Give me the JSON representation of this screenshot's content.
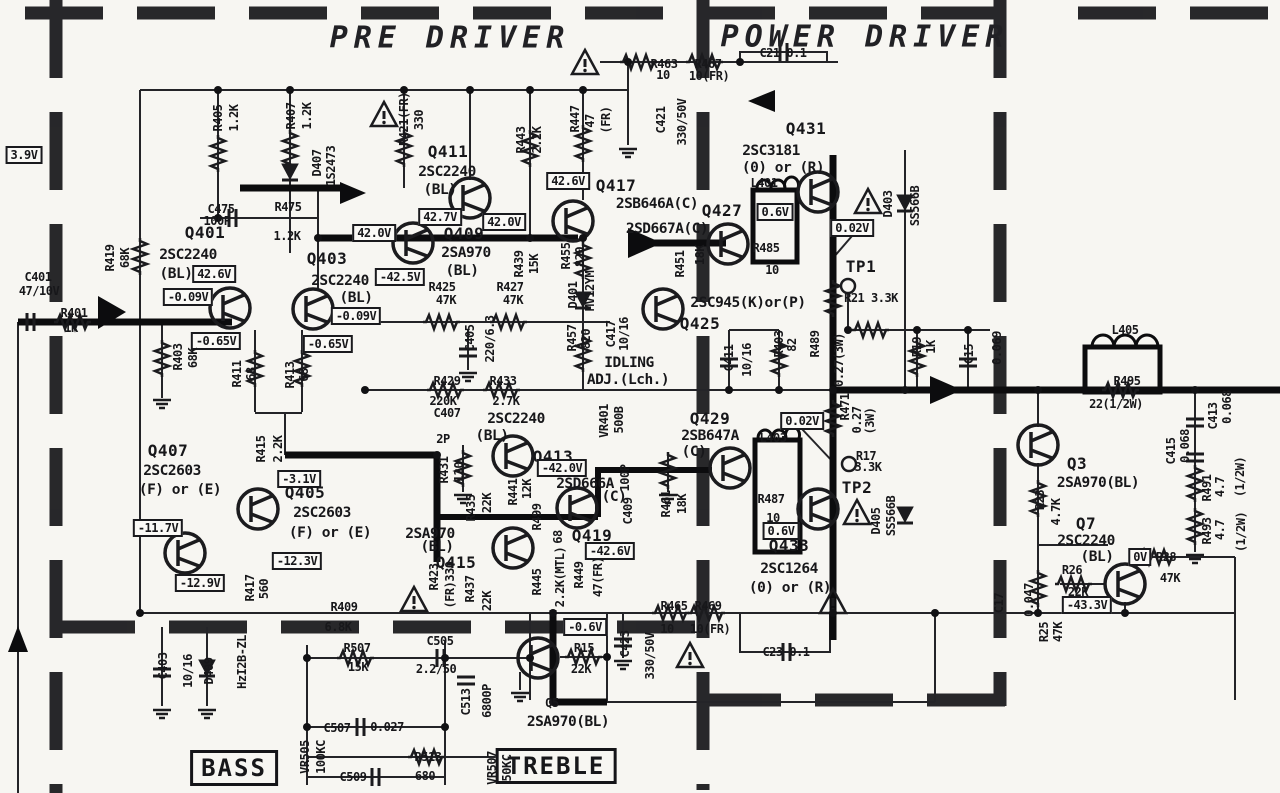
{
  "titles": {
    "pre": "PRE DRIVER",
    "power": "POWER DRIVER"
  },
  "tone": {
    "bass": "BASS",
    "treble": "TREBLE"
  },
  "colors": {
    "ink": "#1b1b1e",
    "paper": "#f7f6f2"
  },
  "labels": [
    {
      "t": "3.9V",
      "x": 24,
      "y": 155,
      "c": "b"
    },
    {
      "t": "R405",
      "x": 218,
      "y": 118,
      "c": "v"
    },
    {
      "t": "1.2K",
      "x": 234,
      "y": 118,
      "c": "v"
    },
    {
      "t": "R407",
      "x": 291,
      "y": 116,
      "c": "v"
    },
    {
      "t": "1.2K",
      "x": 307,
      "y": 116,
      "c": "v"
    },
    {
      "t": "D407",
      "x": 317,
      "y": 163,
      "c": "v"
    },
    {
      "t": "1S2473",
      "x": 331,
      "y": 166,
      "c": "v"
    },
    {
      "t": "R421(FR)",
      "x": 404,
      "y": 119,
      "c": "v"
    },
    {
      "t": "330",
      "x": 419,
      "y": 120,
      "c": "v"
    },
    {
      "t": "R443",
      "x": 521,
      "y": 140,
      "c": "v"
    },
    {
      "t": "2.2K",
      "x": 537,
      "y": 140,
      "c": "v"
    },
    {
      "t": "R447",
      "x": 575,
      "y": 119,
      "c": "v"
    },
    {
      "t": "47",
      "x": 590,
      "y": 121,
      "c": "v"
    },
    {
      "t": "(FR)",
      "x": 606,
      "y": 120,
      "c": "v"
    },
    {
      "t": "C421",
      "x": 661,
      "y": 120,
      "c": "v"
    },
    {
      "t": "330/50V",
      "x": 682,
      "y": 122,
      "c": "v"
    },
    {
      "t": "R463",
      "x": 664,
      "y": 64
    },
    {
      "t": "10",
      "x": 663,
      "y": 75
    },
    {
      "t": "R467",
      "x": 708,
      "y": 64
    },
    {
      "t": "10(FR)",
      "x": 709,
      "y": 76
    },
    {
      "t": "C21 0.1",
      "x": 783,
      "y": 53
    },
    {
      "t": "Q411",
      "x": 448,
      "y": 152,
      "c": "q"
    },
    {
      "t": "2SC2240",
      "x": 447,
      "y": 172,
      "c": "p"
    },
    {
      "t": "(BL)",
      "x": 440,
      "y": 190,
      "c": "p"
    },
    {
      "t": "Q431",
      "x": 806,
      "y": 129,
      "c": "q"
    },
    {
      "t": "2SC3181",
      "x": 771,
      "y": 151,
      "c": "p"
    },
    {
      "t": "(0) or (R)",
      "x": 783,
      "y": 168,
      "c": "p"
    },
    {
      "t": "L401",
      "x": 764,
      "y": 183
    },
    {
      "t": "D403",
      "x": 888,
      "y": 204,
      "c": "v"
    },
    {
      "t": "SS566B",
      "x": 915,
      "y": 206,
      "c": "v"
    },
    {
      "t": "42.6V",
      "x": 568,
      "y": 181,
      "c": "b"
    },
    {
      "t": "Q417",
      "x": 616,
      "y": 186,
      "c": "q"
    },
    {
      "t": "2SB646A(C)",
      "x": 657,
      "y": 204,
      "c": "p"
    },
    {
      "t": "2SD667A(C)",
      "x": 667,
      "y": 229,
      "c": "p"
    },
    {
      "t": "Q427",
      "x": 722,
      "y": 211,
      "c": "q"
    },
    {
      "t": "0.6V",
      "x": 775,
      "y": 212,
      "c": "b"
    },
    {
      "t": "0.02V",
      "x": 852,
      "y": 228,
      "c": "b"
    },
    {
      "t": "C475",
      "x": 221,
      "y": 209
    },
    {
      "t": "100P",
      "x": 217,
      "y": 221
    },
    {
      "t": "R475",
      "x": 288,
      "y": 207
    },
    {
      "t": "1.2K",
      "x": 287,
      "y": 236
    },
    {
      "t": "42.7V",
      "x": 440,
      "y": 217,
      "c": "b"
    },
    {
      "t": "42.0V",
      "x": 504,
      "y": 222,
      "c": "b"
    },
    {
      "t": "42.0V",
      "x": 374,
      "y": 233,
      "c": "b"
    },
    {
      "t": "Q401",
      "x": 205,
      "y": 233,
      "c": "q"
    },
    {
      "t": "2SC2240",
      "x": 188,
      "y": 255,
      "c": "p"
    },
    {
      "t": "(BL)",
      "x": 176,
      "y": 274,
      "c": "p"
    },
    {
      "t": "42.6V",
      "x": 214,
      "y": 274,
      "c": "b"
    },
    {
      "t": "Q409",
      "x": 464,
      "y": 234,
      "c": "q"
    },
    {
      "t": "2SA970",
      "x": 466,
      "y": 253,
      "c": "p"
    },
    {
      "t": "(BL)",
      "x": 462,
      "y": 271,
      "c": "p"
    },
    {
      "t": "Q403",
      "x": 327,
      "y": 259,
      "c": "q"
    },
    {
      "t": "2SC2240",
      "x": 340,
      "y": 281,
      "c": "p"
    },
    {
      "t": "(BL)",
      "x": 356,
      "y": 298,
      "c": "p"
    },
    {
      "t": "-42.5V",
      "x": 400,
      "y": 277,
      "c": "b"
    },
    {
      "t": "C401",
      "x": 38,
      "y": 277
    },
    {
      "t": "47/10V",
      "x": 39,
      "y": 291
    },
    {
      "t": "R419",
      "x": 110,
      "y": 258,
      "c": "v"
    },
    {
      "t": "68K",
      "x": 125,
      "y": 258,
      "c": "v"
    },
    {
      "t": "-0.09V",
      "x": 188,
      "y": 297,
      "c": "b"
    },
    {
      "t": "-0.09V",
      "x": 356,
      "y": 316,
      "c": "b"
    },
    {
      "t": "R401",
      "x": 74,
      "y": 313
    },
    {
      "t": "1K",
      "x": 71,
      "y": 328
    },
    {
      "t": "-0.65V",
      "x": 216,
      "y": 341,
      "c": "b"
    },
    {
      "t": "-0.65V",
      "x": 328,
      "y": 344,
      "c": "b"
    },
    {
      "t": "R403",
      "x": 178,
      "y": 357,
      "c": "v"
    },
    {
      "t": "68K",
      "x": 193,
      "y": 358,
      "c": "v"
    },
    {
      "t": "R411",
      "x": 237,
      "y": 374,
      "c": "v"
    },
    {
      "t": "68",
      "x": 251,
      "y": 374,
      "c": "v"
    },
    {
      "t": "R413",
      "x": 290,
      "y": 375,
      "c": "v"
    },
    {
      "t": "68",
      "x": 304,
      "y": 375,
      "c": "v"
    },
    {
      "t": "R439",
      "x": 519,
      "y": 264,
      "c": "v"
    },
    {
      "t": "15K",
      "x": 534,
      "y": 264,
      "c": "v"
    },
    {
      "t": "R455",
      "x": 566,
      "y": 256,
      "c": "v"
    },
    {
      "t": "820",
      "x": 580,
      "y": 257,
      "c": "v"
    },
    {
      "t": "D401",
      "x": 573,
      "y": 295,
      "c": "v"
    },
    {
      "t": "MV12YM",
      "x": 590,
      "y": 291,
      "c": "v"
    },
    {
      "t": "R425",
      "x": 442,
      "y": 287
    },
    {
      "t": "47K",
      "x": 446,
      "y": 300
    },
    {
      "t": "R427",
      "x": 510,
      "y": 287
    },
    {
      "t": "47K",
      "x": 513,
      "y": 300
    },
    {
      "t": "R451",
      "x": 680,
      "y": 264,
      "c": "v"
    },
    {
      "t": "18K",
      "x": 700,
      "y": 255,
      "c": "v"
    },
    {
      "t": "2SC945(K)or(P)",
      "x": 748,
      "y": 303,
      "c": "p"
    },
    {
      "t": "Q425",
      "x": 700,
      "y": 324,
      "c": "q"
    },
    {
      "t": "R485",
      "x": 766,
      "y": 248
    },
    {
      "t": "10",
      "x": 772,
      "y": 270
    },
    {
      "t": "TP1",
      "x": 861,
      "y": 267,
      "c": "q"
    },
    {
      "t": "R21 3.3K",
      "x": 871,
      "y": 298
    },
    {
      "t": "C405",
      "x": 470,
      "y": 338,
      "c": "v"
    },
    {
      "t": "220/6.3",
      "x": 490,
      "y": 339,
      "c": "v"
    },
    {
      "t": "R457",
      "x": 572,
      "y": 338,
      "c": "v"
    },
    {
      "t": "820",
      "x": 586,
      "y": 339,
      "c": "v"
    },
    {
      "t": "C417",
      "x": 611,
      "y": 334,
      "c": "v"
    },
    {
      "t": "10/16",
      "x": 624,
      "y": 334,
      "c": "v"
    },
    {
      "t": "IDLING",
      "x": 629,
      "y": 363,
      "c": "p"
    },
    {
      "t": "ADJ.(Lch.)",
      "x": 628,
      "y": 380,
      "c": "p"
    },
    {
      "t": "C411",
      "x": 729,
      "y": 358,
      "c": "v"
    },
    {
      "t": "10/16",
      "x": 747,
      "y": 360,
      "c": "v"
    },
    {
      "t": "R403",
      "x": 779,
      "y": 344,
      "c": "v"
    },
    {
      "t": "82",
      "x": 792,
      "y": 345,
      "c": "v"
    },
    {
      "t": "R489",
      "x": 815,
      "y": 344,
      "c": "v"
    },
    {
      "t": "0.27(3W)",
      "x": 839,
      "y": 360,
      "c": "v"
    },
    {
      "t": "R19",
      "x": 917,
      "y": 347,
      "c": "v"
    },
    {
      "t": "1K",
      "x": 931,
      "y": 347,
      "c": "v"
    },
    {
      "t": "C15",
      "x": 969,
      "y": 354,
      "c": "v"
    },
    {
      "t": "0.069",
      "x": 997,
      "y": 348,
      "c": "v"
    },
    {
      "t": "L405",
      "x": 1125,
      "y": 330
    },
    {
      "t": "R495",
      "x": 1127,
      "y": 381
    },
    {
      "t": "22(1/2W)",
      "x": 1116,
      "y": 404
    },
    {
      "t": "R429",
      "x": 447,
      "y": 381
    },
    {
      "t": "220K",
      "x": 443,
      "y": 401
    },
    {
      "t": "C407",
      "x": 447,
      "y": 413
    },
    {
      "t": "2P",
      "x": 443,
      "y": 439
    },
    {
      "t": "R433",
      "x": 503,
      "y": 381
    },
    {
      "t": "2.7K",
      "x": 506,
      "y": 401
    },
    {
      "t": "2SC2240",
      "x": 516,
      "y": 419,
      "c": "p"
    },
    {
      "t": "(BL)",
      "x": 492,
      "y": 436,
      "c": "p"
    },
    {
      "t": "VR401",
      "x": 604,
      "y": 421,
      "c": "v"
    },
    {
      "t": "500B",
      "x": 619,
      "y": 420,
      "c": "v"
    },
    {
      "t": "Q413",
      "x": 553,
      "y": 457,
      "c": "q"
    },
    {
      "t": "-42.0V",
      "x": 562,
      "y": 468,
      "c": "b"
    },
    {
      "t": "2SD666A",
      "x": 585,
      "y": 484,
      "c": "p"
    },
    {
      "t": "(C)",
      "x": 614,
      "y": 497,
      "c": "p"
    },
    {
      "t": "C409",
      "x": 628,
      "y": 511,
      "c": "v"
    },
    {
      "t": "100P",
      "x": 625,
      "y": 478,
      "c": "v"
    },
    {
      "t": "Q429",
      "x": 710,
      "y": 419,
      "c": "q"
    },
    {
      "t": "2SB647A",
      "x": 710,
      "y": 436,
      "c": "p"
    },
    {
      "t": "(C)",
      "x": 694,
      "y": 452,
      "c": "p"
    },
    {
      "t": "L403",
      "x": 773,
      "y": 438
    },
    {
      "t": "0.02V",
      "x": 802,
      "y": 421,
      "c": "b"
    },
    {
      "t": "R471",
      "x": 845,
      "y": 407,
      "c": "v"
    },
    {
      "t": "0.27",
      "x": 857,
      "y": 420,
      "c": "v"
    },
    {
      "t": "(3W)",
      "x": 870,
      "y": 421,
      "c": "v"
    },
    {
      "t": "R17",
      "x": 866,
      "y": 456
    },
    {
      "t": "3.3K",
      "x": 868,
      "y": 467
    },
    {
      "t": "TP2",
      "x": 857,
      "y": 488,
      "c": "q"
    },
    {
      "t": "R487",
      "x": 771,
      "y": 499
    },
    {
      "t": "10",
      "x": 773,
      "y": 518
    },
    {
      "t": "0.6V",
      "x": 781,
      "y": 531,
      "c": "b"
    },
    {
      "t": "Q433",
      "x": 789,
      "y": 546,
      "c": "q"
    },
    {
      "t": "2SC1264",
      "x": 789,
      "y": 569,
      "c": "p"
    },
    {
      "t": "(0) or (R)",
      "x": 790,
      "y": 588,
      "c": "p"
    },
    {
      "t": "D405",
      "x": 876,
      "y": 521,
      "c": "v"
    },
    {
      "t": "SS566B",
      "x": 891,
      "y": 516,
      "c": "v"
    },
    {
      "t": "R461",
      "x": 666,
      "y": 504,
      "c": "v"
    },
    {
      "t": "18K",
      "x": 682,
      "y": 504,
      "c": "v"
    },
    {
      "t": "R441",
      "x": 513,
      "y": 492,
      "c": "v"
    },
    {
      "t": "12K",
      "x": 527,
      "y": 489,
      "c": "v"
    },
    {
      "t": "R435",
      "x": 471,
      "y": 508,
      "c": "v"
    },
    {
      "t": "22K",
      "x": 487,
      "y": 503,
      "c": "v"
    },
    {
      "t": "R431",
      "x": 444,
      "y": 470,
      "c": "v"
    },
    {
      "t": "120",
      "x": 459,
      "y": 472,
      "c": "v"
    },
    {
      "t": "R499",
      "x": 537,
      "y": 517,
      "c": "v"
    },
    {
      "t": "68",
      "x": 558,
      "y": 537,
      "c": "v"
    },
    {
      "t": "Q419",
      "x": 592,
      "y": 536,
      "c": "q"
    },
    {
      "t": "-42.6V",
      "x": 610,
      "y": 551,
      "c": "b"
    },
    {
      "t": "2SA970",
      "x": 430,
      "y": 534,
      "c": "p"
    },
    {
      "t": "(BL)",
      "x": 437,
      "y": 547,
      "c": "p"
    },
    {
      "t": "Q415",
      "x": 456,
      "y": 563,
      "c": "q"
    },
    {
      "t": "Q407",
      "x": 168,
      "y": 451,
      "c": "q"
    },
    {
      "t": "2SC2603",
      "x": 172,
      "y": 471,
      "c": "p"
    },
    {
      "t": "(F) or (E)",
      "x": 180,
      "y": 490,
      "c": "p"
    },
    {
      "t": "R415",
      "x": 261,
      "y": 449,
      "c": "v"
    },
    {
      "t": "2.2K",
      "x": 278,
      "y": 449,
      "c": "v"
    },
    {
      "t": "-3.1V",
      "x": 299,
      "y": 479,
      "c": "b"
    },
    {
      "t": "Q405",
      "x": 305,
      "y": 493,
      "c": "q"
    },
    {
      "t": "2SC2603",
      "x": 322,
      "y": 513,
      "c": "p"
    },
    {
      "t": "(F) or (E)",
      "x": 330,
      "y": 533,
      "c": "p"
    },
    {
      "t": "-11.7V",
      "x": 158,
      "y": 528,
      "c": "b"
    },
    {
      "t": "-12.3V",
      "x": 297,
      "y": 561,
      "c": "b"
    },
    {
      "t": "-12.9V",
      "x": 200,
      "y": 583,
      "c": "b"
    },
    {
      "t": "R417",
      "x": 250,
      "y": 588,
      "c": "v"
    },
    {
      "t": "560",
      "x": 264,
      "y": 589,
      "c": "v"
    },
    {
      "t": "R423",
      "x": 434,
      "y": 577,
      "c": "v"
    },
    {
      "t": "(FR)330",
      "x": 450,
      "y": 585,
      "c": "v"
    },
    {
      "t": "R437",
      "x": 470,
      "y": 589,
      "c": "v"
    },
    {
      "t": "22K",
      "x": 487,
      "y": 601,
      "c": "v"
    },
    {
      "t": "R445",
      "x": 537,
      "y": 582,
      "c": "v"
    },
    {
      "t": "2.2K(MTL)",
      "x": 560,
      "y": 577,
      "c": "v"
    },
    {
      "t": "R449",
      "x": 579,
      "y": 575,
      "c": "v"
    },
    {
      "t": "47(FR)",
      "x": 598,
      "y": 577,
      "c": "v"
    },
    {
      "t": "R409",
      "x": 344,
      "y": 607
    },
    {
      "t": "6.8K",
      "x": 338,
      "y": 627
    },
    {
      "t": "R465",
      "x": 674,
      "y": 606
    },
    {
      "t": "10",
      "x": 667,
      "y": 629
    },
    {
      "t": "R469",
      "x": 708,
      "y": 606
    },
    {
      "t": "10(FR)",
      "x": 710,
      "y": 629
    },
    {
      "t": "C23 0.1",
      "x": 786,
      "y": 652
    },
    {
      "t": "C423",
      "x": 625,
      "y": 644,
      "c": "v"
    },
    {
      "t": "330/50V",
      "x": 650,
      "y": 656,
      "c": "v"
    },
    {
      "t": "-0.6V",
      "x": 585,
      "y": 627,
      "c": "b"
    },
    {
      "t": "R15",
      "x": 584,
      "y": 648
    },
    {
      "t": "22K",
      "x": 581,
      "y": 669
    },
    {
      "t": "Q5",
      "x": 552,
      "y": 703
    },
    {
      "t": "2SA970(BL)",
      "x": 568,
      "y": 722,
      "c": "p"
    },
    {
      "t": "C403",
      "x": 163,
      "y": 666,
      "c": "v"
    },
    {
      "t": "10/16",
      "x": 188,
      "y": 671,
      "c": "v"
    },
    {
      "t": "D409",
      "x": 209,
      "y": 671,
      "c": "v"
    },
    {
      "t": "HzI2B-ZL",
      "x": 242,
      "y": 662,
      "c": "v"
    },
    {
      "t": "R507",
      "x": 357,
      "y": 648
    },
    {
      "t": "15K",
      "x": 358,
      "y": 667
    },
    {
      "t": "C505",
      "x": 440,
      "y": 641
    },
    {
      "t": "2.2/50",
      "x": 436,
      "y": 669
    },
    {
      "t": "C513",
      "x": 466,
      "y": 702,
      "c": "v"
    },
    {
      "t": "6800P",
      "x": 487,
      "y": 701,
      "c": "v"
    },
    {
      "t": "C507",
      "x": 337,
      "y": 728
    },
    {
      "t": "0.027",
      "x": 387,
      "y": 727
    },
    {
      "t": "R513",
      "x": 428,
      "y": 757
    },
    {
      "t": "680",
      "x": 425,
      "y": 776
    },
    {
      "t": "C509",
      "x": 353,
      "y": 777
    },
    {
      "t": "VR505",
      "x": 305,
      "y": 757,
      "c": "v"
    },
    {
      "t": "100KC",
      "x": 321,
      "y": 757,
      "c": "v"
    },
    {
      "t": "VR507",
      "x": 492,
      "y": 768,
      "c": "v"
    },
    {
      "t": "50KC",
      "x": 507,
      "y": 768,
      "c": "v"
    },
    {
      "t": "Q3",
      "x": 1077,
      "y": 464,
      "c": "q"
    },
    {
      "t": "2SA970(BL)",
      "x": 1098,
      "y": 483,
      "c": "p"
    },
    {
      "t": "R23",
      "x": 1040,
      "y": 500,
      "c": "v"
    },
    {
      "t": "4.7K",
      "x": 1056,
      "y": 512,
      "c": "v"
    },
    {
      "t": "C413",
      "x": 1213,
      "y": 416,
      "c": "v"
    },
    {
      "t": "0.068",
      "x": 1227,
      "y": 407,
      "c": "v"
    },
    {
      "t": "C415",
      "x": 1171,
      "y": 451,
      "c": "v"
    },
    {
      "t": "0.068",
      "x": 1185,
      "y": 446,
      "c": "v"
    },
    {
      "t": "R491",
      "x": 1207,
      "y": 488,
      "c": "v"
    },
    {
      "t": "4.7",
      "x": 1220,
      "y": 487,
      "c": "v"
    },
    {
      "t": "(1/2W)",
      "x": 1240,
      "y": 477,
      "c": "v"
    },
    {
      "t": "R493",
      "x": 1207,
      "y": 531,
      "c": "v"
    },
    {
      "t": "4.7",
      "x": 1220,
      "y": 530,
      "c": "v"
    },
    {
      "t": "(1/2W)",
      "x": 1241,
      "y": 532,
      "c": "v"
    },
    {
      "t": "Q7",
      "x": 1086,
      "y": 524,
      "c": "q"
    },
    {
      "t": "2SC2240",
      "x": 1086,
      "y": 541,
      "c": "p"
    },
    {
      "t": "(BL)",
      "x": 1097,
      "y": 557,
      "c": "p"
    },
    {
      "t": "R26",
      "x": 1072,
      "y": 570
    },
    {
      "t": "22K",
      "x": 1078,
      "y": 592
    },
    {
      "t": "-43.3V",
      "x": 1087,
      "y": 605,
      "c": "b"
    },
    {
      "t": "0V",
      "x": 1140,
      "y": 557,
      "c": "b"
    },
    {
      "t": "R28",
      "x": 1166,
      "y": 557
    },
    {
      "t": "47K",
      "x": 1170,
      "y": 578
    },
    {
      "t": "C17",
      "x": 999,
      "y": 603,
      "c": "v"
    },
    {
      "t": "0.047",
      "x": 1029,
      "y": 600,
      "c": "v"
    },
    {
      "t": "R25",
      "x": 1044,
      "y": 632,
      "c": "v"
    },
    {
      "t": "47K",
      "x": 1058,
      "y": 632,
      "c": "v"
    }
  ]
}
